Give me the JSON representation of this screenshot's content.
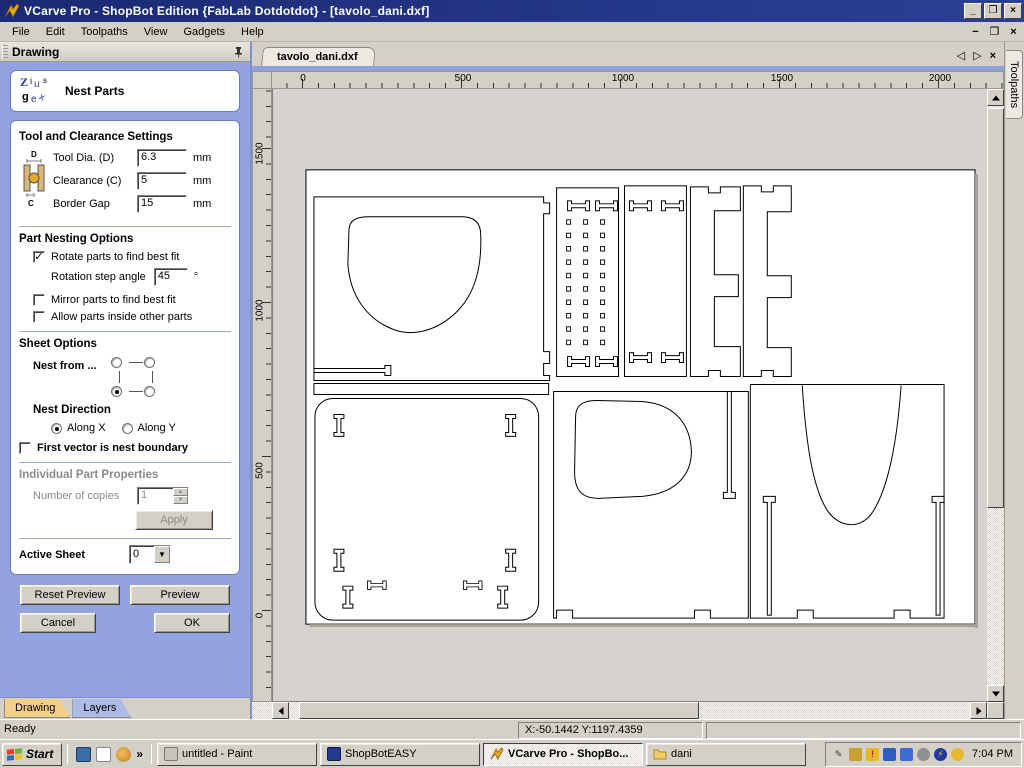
{
  "window": {
    "title": "VCarve Pro - ShopBot Edition {FabLab Dotdotdot} - [tavolo_dani.dxf]"
  },
  "icons": {
    "minimize": "_",
    "restore": "❐",
    "close": "×",
    "mdi_minimize": "−",
    "mdi_restore": "❐",
    "mdi_close": "×",
    "tab_prev": "◁",
    "tab_next": "▷",
    "tab_close": "×",
    "check": "✓",
    "dropdown_arrow": "▼",
    "spin_up": "▲",
    "spin_down": "▼",
    "quick_chevron": "»"
  },
  "menu": {
    "items": [
      "File",
      "Edit",
      "Toolpaths",
      "View",
      "Gadgets",
      "Help"
    ]
  },
  "panel": {
    "header": "Drawing",
    "title": "Nest Parts",
    "tool_clearance": {
      "title": "Tool and Clearance Settings",
      "fields": [
        {
          "label": "Tool Dia. (D)",
          "value": "6.3",
          "unit": "mm"
        },
        {
          "label": "Clearance (C)",
          "value": "5",
          "unit": "mm"
        },
        {
          "label": "Border Gap",
          "value": "15",
          "unit": "mm"
        }
      ],
      "diagram_labels": {
        "top": "D",
        "bottom": "C"
      }
    },
    "part_nesting": {
      "title": "Part Nesting Options",
      "rotate_label": "Rotate parts to find best fit",
      "rotate_checked": true,
      "rotation_step_label": "Rotation step angle",
      "rotation_step_value": "45",
      "rotation_step_unit": "°",
      "mirror_label": "Mirror parts to find best fit",
      "mirror_checked": false,
      "allow_label": "Allow parts inside other parts",
      "allow_checked": false
    },
    "sheet_options": {
      "title": "Sheet Options",
      "nest_from_label": "Nest from ...",
      "nest_from_selected": "bottom-left",
      "nest_direction_label": "Nest Direction",
      "along_x_label": "Along X",
      "along_y_label": "Along Y",
      "direction_selected": "Along X",
      "first_vector_label": "First vector is nest boundary",
      "first_vector_checked": false
    },
    "individual": {
      "title": "Individual Part Properties",
      "copies_label": "Number of copies",
      "copies_value": "1",
      "apply_label": "Apply",
      "enabled": false
    },
    "active_sheet": {
      "label": "Active Sheet",
      "value": "0"
    },
    "buttons": {
      "reset_preview": "Reset Preview",
      "preview": "Preview",
      "cancel": "Cancel",
      "ok": "OK"
    },
    "tabs": [
      {
        "label": "Drawing",
        "active": true
      },
      {
        "label": "Layers",
        "active": false
      }
    ]
  },
  "canvas": {
    "doc_tab": "tavolo_dani.dxf",
    "toolpaths_tab": "Toolpaths",
    "h_ruler": [
      "0",
      "500",
      "1000",
      "1500",
      "2000"
    ],
    "v_ruler": [
      "1500",
      "1000",
      "500",
      "0"
    ]
  },
  "status": {
    "ready": "Ready",
    "coords": "X:-50.1442 Y:1197.4359"
  },
  "taskbar": {
    "start": "Start",
    "tasks": [
      {
        "label": "untitled - Paint",
        "active": false
      },
      {
        "label": "ShopBotEASY",
        "active": false
      },
      {
        "label": "VCarve Pro - ShopBo...",
        "active": true
      },
      {
        "label": "dani",
        "active": false
      }
    ],
    "clock": "7:04 PM"
  }
}
